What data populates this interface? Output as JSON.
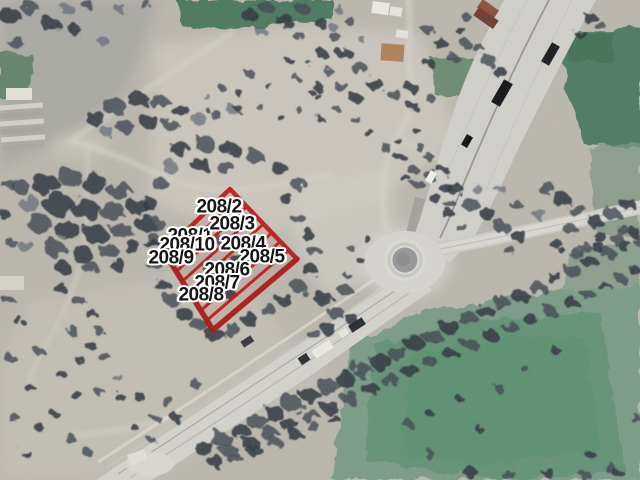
{
  "map": {
    "block_number": "208",
    "parcel_labels": [
      {
        "text": "208/1"
      },
      {
        "text": "208/2"
      },
      {
        "text": "208/3"
      },
      {
        "text": "208/10"
      },
      {
        "text": "208/4"
      },
      {
        "text": "208/9"
      },
      {
        "text": "208/5"
      },
      {
        "text": "208/6"
      },
      {
        "text": "208/7"
      },
      {
        "text": "208/8"
      }
    ],
    "colors": {
      "parcel_outline": "#bb1612",
      "label_text": "#161616",
      "label_halo": "#ffffff",
      "terrain": "#bcb8af",
      "road": "#d6d4cf",
      "tree_cover": "#343b44",
      "field_green": "#6f9883"
    }
  }
}
